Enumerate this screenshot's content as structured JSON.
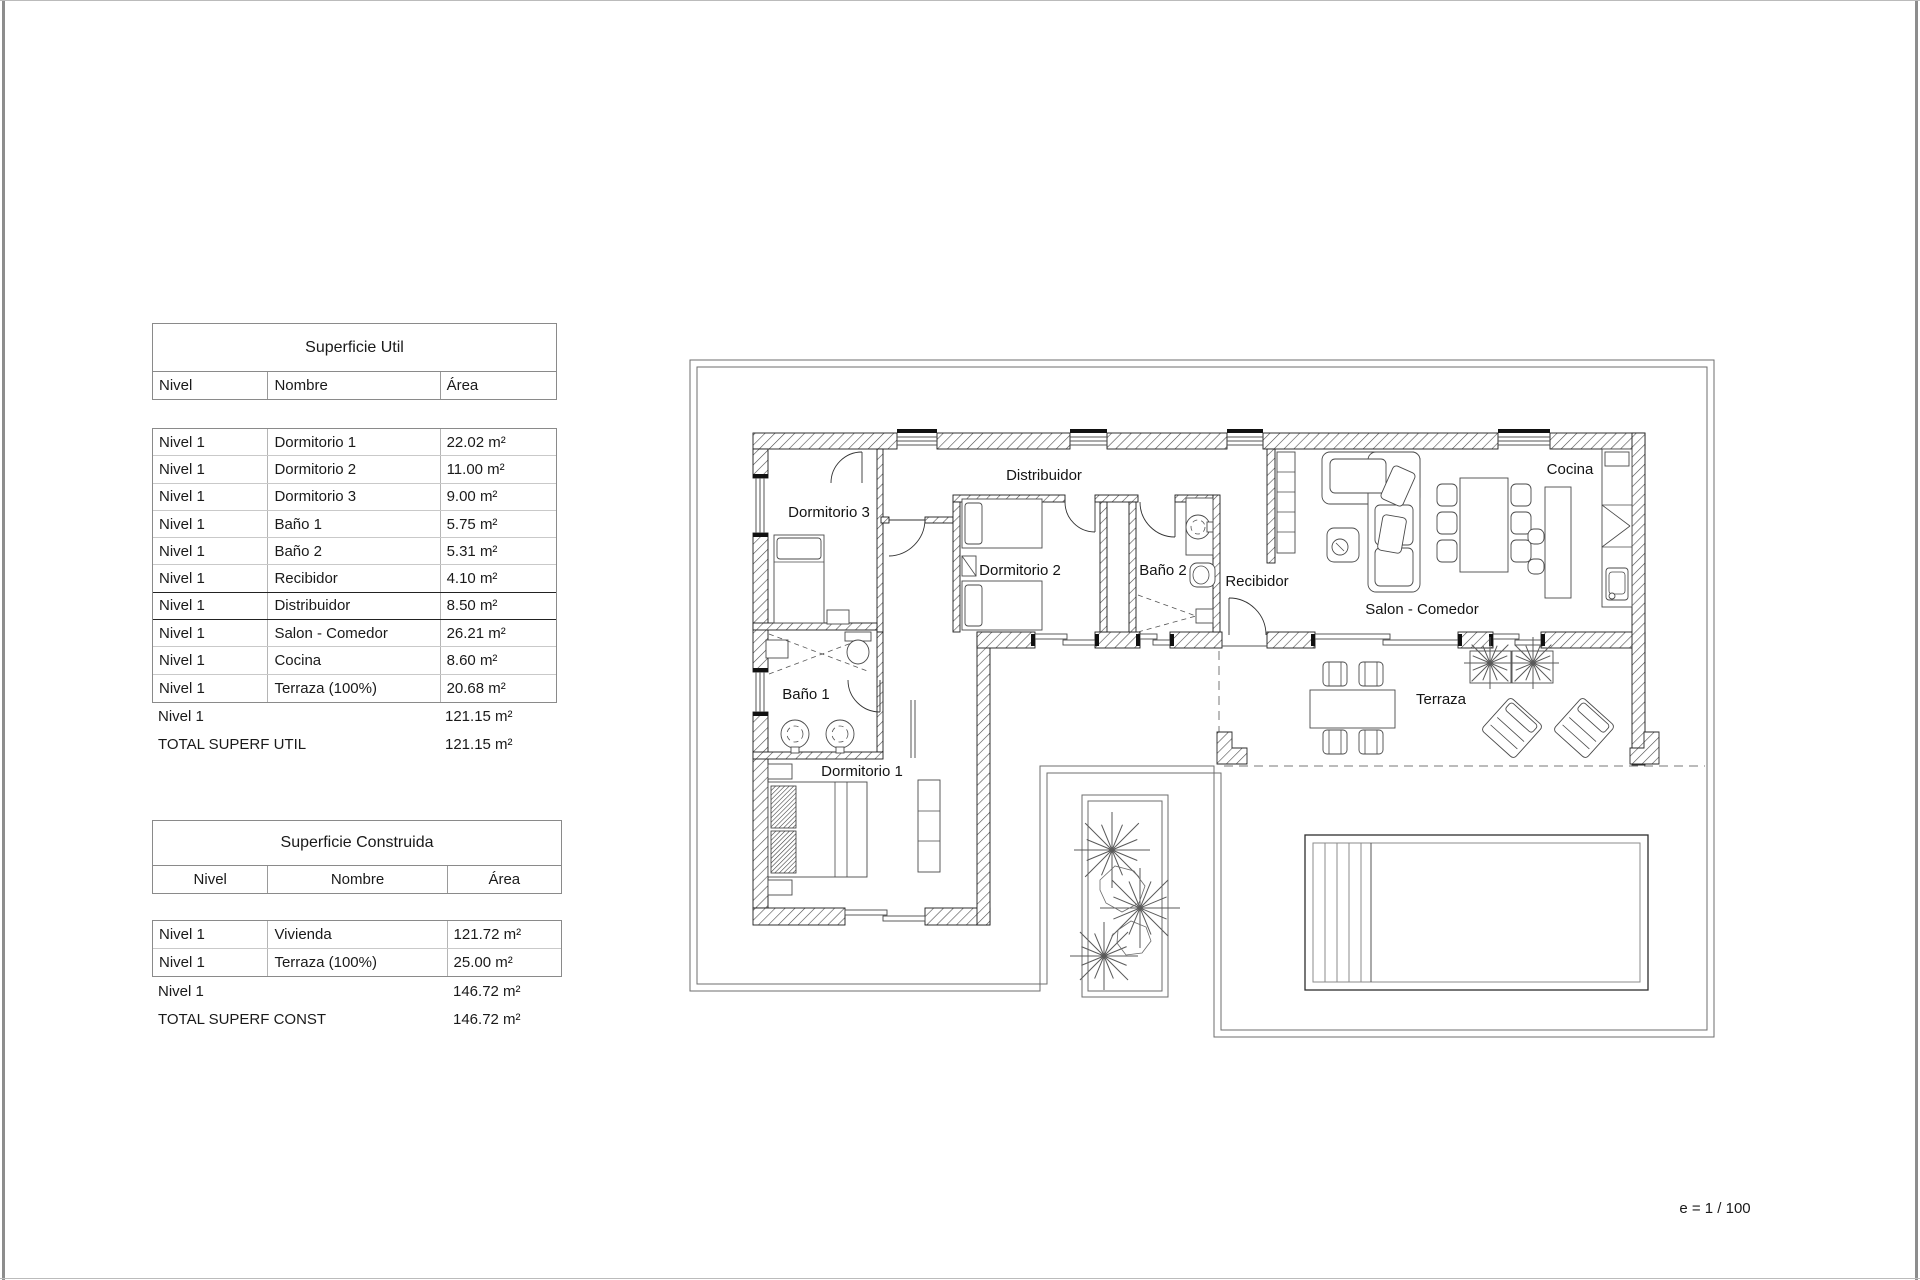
{
  "page": {
    "scale_label": "e = 1 / 100"
  },
  "tables": {
    "superficie_util": {
      "title": "Superficie Util",
      "columns": {
        "nivel": "Nivel",
        "nombre": "Nombre",
        "area": "Área"
      },
      "rows": [
        {
          "nivel": "Nivel 1",
          "nombre": "Dormitorio 1",
          "area": "22.02 m²"
        },
        {
          "nivel": "Nivel 1",
          "nombre": "Dormitorio 2",
          "area": "11.00 m²"
        },
        {
          "nivel": "Nivel 1",
          "nombre": "Dormitorio 3",
          "area": "9.00 m²"
        },
        {
          "nivel": "Nivel 1",
          "nombre": "Baño 1",
          "area": "5.75 m²"
        },
        {
          "nivel": "Nivel 1",
          "nombre": "Baño 2",
          "area": "5.31 m²"
        },
        {
          "nivel": "Nivel 1",
          "nombre": "Recibidor",
          "area": "4.10 m²"
        },
        {
          "nivel": "Nivel 1",
          "nombre": "Distribuidor",
          "area": "8.50 m²"
        },
        {
          "nivel": "Nivel 1",
          "nombre": "Salon - Comedor",
          "area": "26.21 m²"
        },
        {
          "nivel": "Nivel 1",
          "nombre": "Cocina",
          "area": "8.60 m²"
        },
        {
          "nivel": "Nivel 1",
          "nombre": "Terraza (100%)",
          "area": "20.68 m²"
        }
      ],
      "subtotal": {
        "label": "Nivel 1",
        "area": "121.15 m²"
      },
      "total": {
        "label": "TOTAL SUPERF UTIL",
        "area": "121.15 m²"
      }
    },
    "superficie_construida": {
      "title": "Superficie Construida",
      "columns": {
        "nivel": "Nivel",
        "nombre": "Nombre",
        "area": "Área"
      },
      "rows": [
        {
          "nivel": "Nivel 1",
          "nombre": "Vivienda",
          "area": "121.72 m²"
        },
        {
          "nivel": "Nivel 1",
          "nombre": "Terraza (100%)",
          "area": "25.00 m²"
        }
      ],
      "subtotal": {
        "label": "Nivel 1",
        "area": "146.72 m²"
      },
      "total": {
        "label": "TOTAL SUPERF CONST",
        "area": "146.72 m²"
      }
    }
  },
  "floorplan": {
    "labels": {
      "dormitorio1": "Dormitorio 1",
      "dormitorio2": "Dormitorio 2",
      "dormitorio3": "Dormitorio 3",
      "banyo1": "Baño 1",
      "banyo2": "Baño 2",
      "recibidor": "Recibidor",
      "distribuidor": "Distribuidor",
      "salon_comedor": "Salon - Comedor",
      "cocina": "Cocina",
      "terraza": "Terraza"
    }
  }
}
